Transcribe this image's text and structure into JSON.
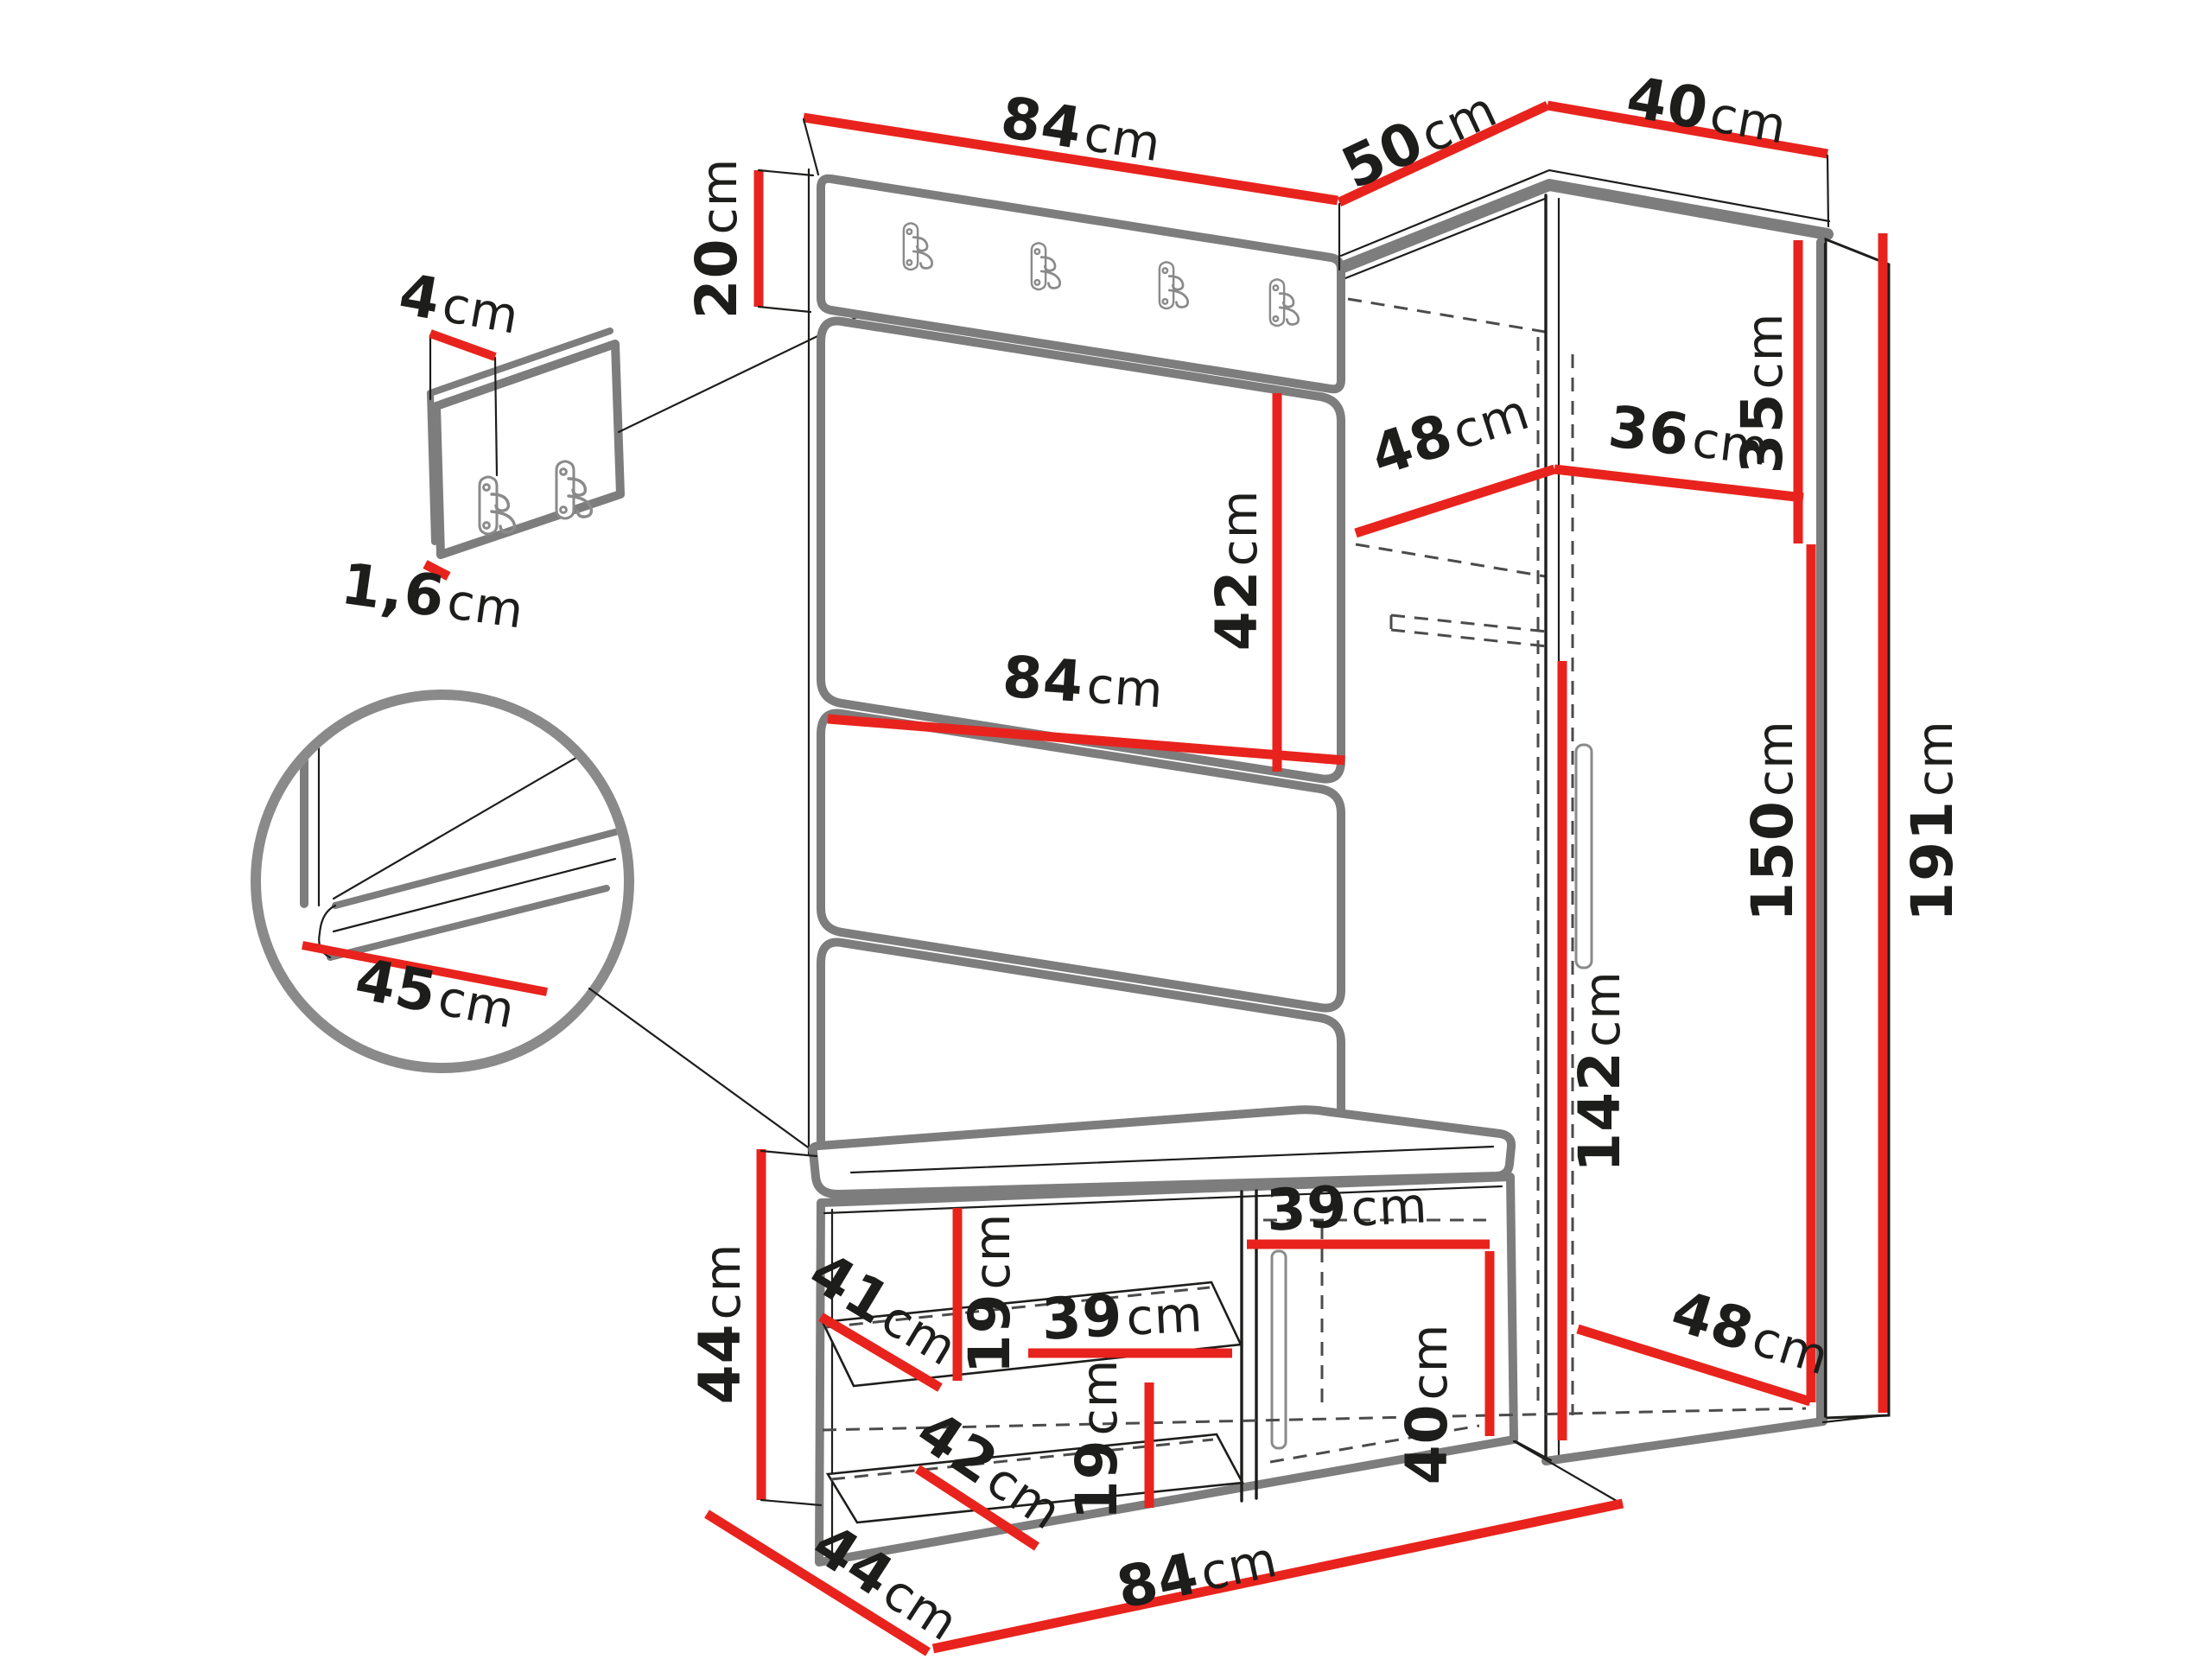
{
  "title": "Hallway wardrobe set - dimensioned technical drawing",
  "unit": "cm",
  "colors": {
    "dimension_line": "#e8231d",
    "drawing_gray": "#7d7d7d",
    "drawing_black": "#1d1d1b",
    "background": "#ffffff"
  },
  "icons": {
    "coat_hook": "double-wall-hook"
  },
  "dimensions": {
    "top_width": {
      "value": "84",
      "unit": "cm"
    },
    "corner_left_depth": {
      "value": "50",
      "unit": "cm"
    },
    "corner_right_width": {
      "value": "40",
      "unit": "cm"
    },
    "hook_panel_height": {
      "value": "20",
      "unit": "cm"
    },
    "hook_plate_width": {
      "value": "4",
      "unit": "cm"
    },
    "hook_plate_thickness": {
      "value": "1,6",
      "unit": "cm"
    },
    "upholstered_panel_height": {
      "value": "42",
      "unit": "cm"
    },
    "corner_shelf_depth": {
      "value": "48",
      "unit": "cm"
    },
    "corner_shelf_width": {
      "value": "36",
      "unit": "cm"
    },
    "top_compartment_height": {
      "value": "35",
      "unit": "cm"
    },
    "panel_width_middle": {
      "value": "84",
      "unit": "cm"
    },
    "seat_depth_detail": {
      "value": "45",
      "unit": "cm"
    },
    "total_height": {
      "value": "191",
      "unit": "cm"
    },
    "interior_height": {
      "value": "150",
      "unit": "cm"
    },
    "hanging_space_height": {
      "value": "142",
      "unit": "cm"
    },
    "bench_height": {
      "value": "44",
      "unit": "cm"
    },
    "bench_shelf_depth": {
      "value": "41",
      "unit": "cm"
    },
    "bench_opening_upper": {
      "value": "19",
      "unit": "cm"
    },
    "bench_shelf_width": {
      "value": "39",
      "unit": "cm"
    },
    "bench_lower_shelf_depth": {
      "value": "42",
      "unit": "cm"
    },
    "bench_opening_lower": {
      "value": "19",
      "unit": "cm"
    },
    "bench_door_width": {
      "value": "39",
      "unit": "cm"
    },
    "bench_door_height": {
      "value": "40",
      "unit": "cm"
    },
    "wardrobe_floor_depth": {
      "value": "48",
      "unit": "cm"
    },
    "bench_depth": {
      "value": "44",
      "unit": "cm"
    },
    "bench_width": {
      "value": "84",
      "unit": "cm"
    }
  }
}
